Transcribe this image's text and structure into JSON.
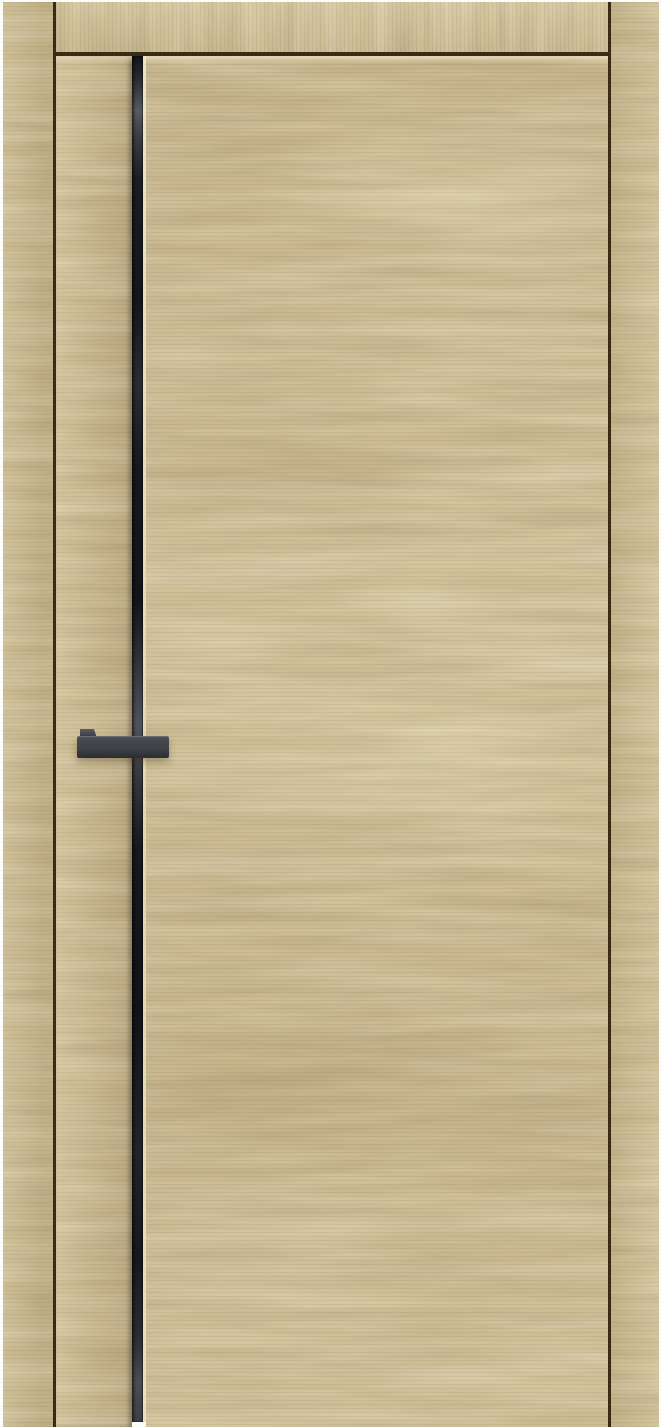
{
  "scene": {
    "type": "product-photo",
    "description": "Closed interior door in light natural oak veneer with horizontal grain, set in matching frame casings. A full-height black aluminum insert strip runs beside the narrow left stile of the leaf, and a matte black rectangular lever handle is mounted across it. White studio background, no visible text.",
    "background": "white"
  },
  "parts": {
    "frame_left": "Door frame casing - left jamb",
    "frame_top": "Door frame casing - head",
    "frame_right": "Door frame casing - right jamb",
    "gap_left": "Shadow gap between left casing and door leaf",
    "gap_top": "Shadow gap between head casing and door leaf",
    "gap_right": "Shadow gap between door leaf and right casing",
    "stile": "Door leaf - narrow left stile",
    "insert_strip": "Black aluminum vertical insert strip",
    "insert_edge": "Light veneer edge line along insert strip",
    "panel": "Door leaf - main panel",
    "top_bevel": "Light bevel along top edge of door leaf",
    "handle_neck": "Handle neck (small upper return at left end)",
    "handle_grip": "Matte black rectangular lever handle"
  },
  "colors": {
    "background": "#fcfcfa",
    "wood_panel": "#d0c097",
    "wood_stile": "#cdbd94",
    "wood_frame_left": "#cbbc93",
    "wood_frame_top": "#d4c59d",
    "wood_frame_right": "#cfc096",
    "grain_dark": "#6b5733",
    "grain_light": "#f2e6bd",
    "seam": "#3a2b15",
    "leaf_top_bevel": "#ded2a9",
    "insert_black": "#1a1b1d",
    "insert_reflection": "#565b61",
    "insert_edge_highlight": "#e9e0c0",
    "handle_face": "#3f4246",
    "handle_top": "#54575c",
    "handle_dark": "#2b2d30"
  }
}
